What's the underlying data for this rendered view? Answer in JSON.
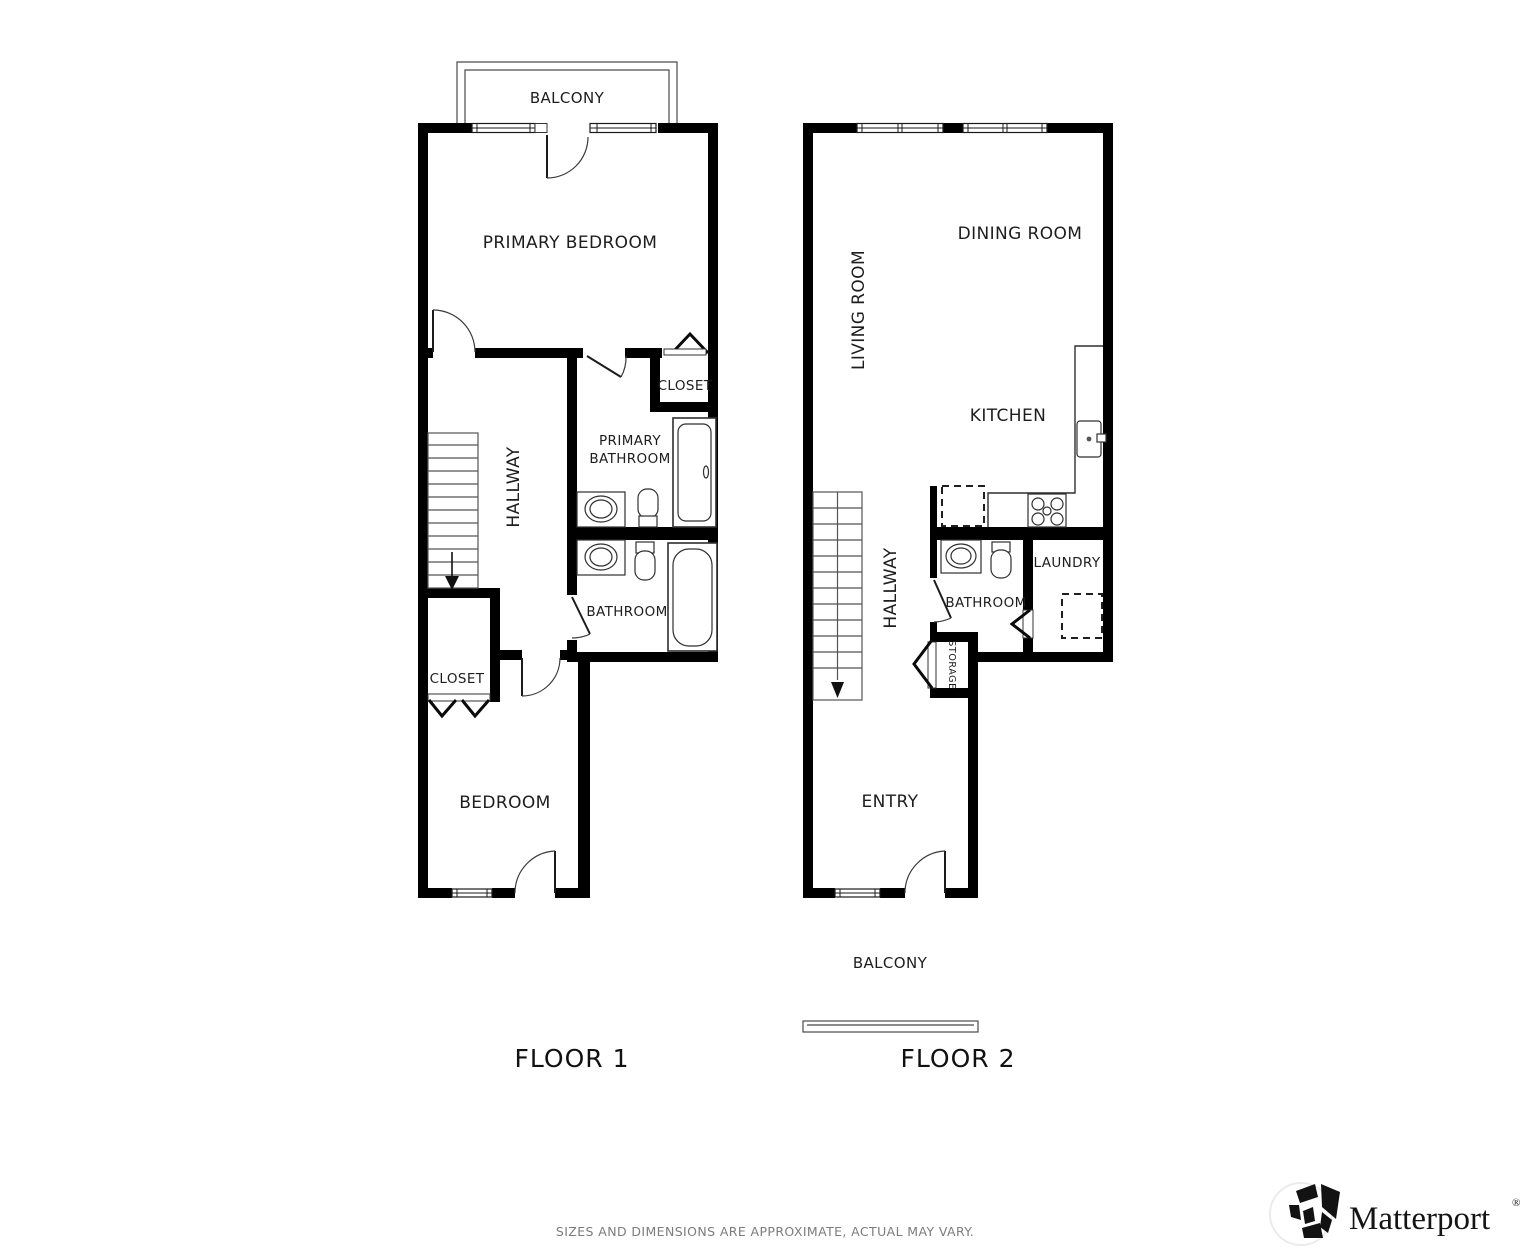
{
  "floors": {
    "floor1": {
      "label": "FLOOR 1",
      "rooms": {
        "balcony": "BALCONY",
        "primary_bedroom": "PRIMARY BEDROOM",
        "closet_top": "CLOSET",
        "primary_bathroom_line1": "PRIMARY",
        "primary_bathroom_line2": "BATHROOM",
        "hallway": "HALLWAY",
        "bathroom": "BATHROOM",
        "closet_bottom": "CLOSET",
        "bedroom": "BEDROOM"
      }
    },
    "floor2": {
      "label": "FLOOR 2",
      "rooms": {
        "living_room": "LIVING ROOM",
        "dining_room": "DINING ROOM",
        "kitchen": "KITCHEN",
        "hallway": "HALLWAY",
        "bathroom": "BATHROOM",
        "laundry": "LAUNDRY",
        "storage": "STORAGE",
        "entry": "ENTRY",
        "balcony": "BALCONY"
      }
    }
  },
  "footer": {
    "disclaimer": "SIZES AND DIMENSIONS ARE APPROXIMATE, ACTUAL MAY VARY."
  },
  "branding": {
    "wordmark": "Matterport",
    "registered_mark": "®"
  },
  "colors": {
    "wall": "#000000",
    "fixture_line": "#2f2f2f",
    "label_text": "#1d1d1d",
    "muted_text": "#7c7c7c"
  }
}
